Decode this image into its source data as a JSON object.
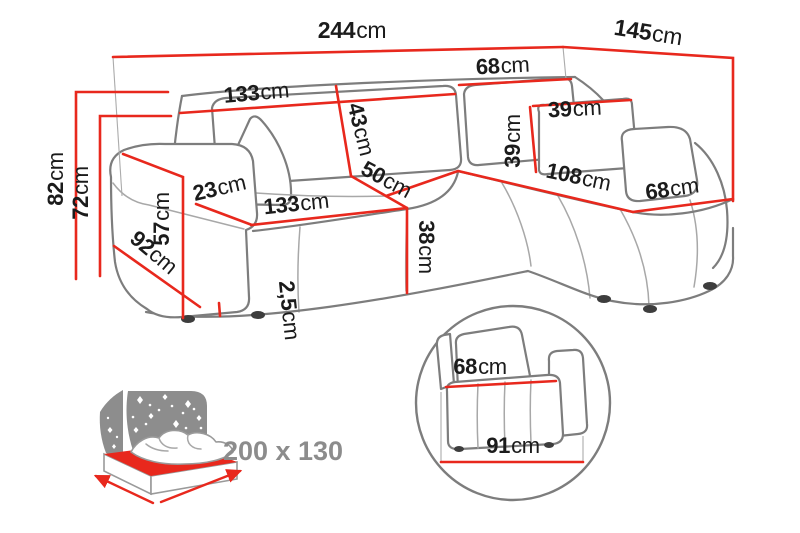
{
  "unit_default": "cm",
  "colors": {
    "dimension_red": "#e8281d",
    "sofa_outline_gray": "#7d7d7d",
    "label_text": "#1b1b1b",
    "muted_gray_label": "#8c8c8c",
    "background": "#ffffff"
  },
  "dims": {
    "total_width": {
      "num": "244",
      "unit": "cm"
    },
    "total_depth": {
      "num": "145",
      "unit": "cm"
    },
    "backrest_left_width": {
      "num": "133",
      "unit": "cm"
    },
    "backrest_right_width": {
      "num": "68",
      "unit": "cm"
    },
    "backrest_height": {
      "num": "43",
      "unit": "cm"
    },
    "pillow_width": {
      "num": "39",
      "unit": "cm"
    },
    "pillow_height": {
      "num": "39",
      "unit": "cm"
    },
    "total_height": {
      "num": "82",
      "unit": "cm"
    },
    "backrest_top_height": {
      "num": "72",
      "unit": "cm"
    },
    "armrest_width": {
      "num": "23",
      "unit": "cm"
    },
    "armrest_height": {
      "num": "57",
      "unit": "cm"
    },
    "armrest_depth": {
      "num": "92",
      "unit": "cm"
    },
    "seat_width": {
      "num": "133",
      "unit": "cm"
    },
    "seat_height": {
      "num": "38",
      "unit": "cm"
    },
    "seat_depth": {
      "num": "50",
      "unit": "cm"
    },
    "chaise_length": {
      "num": "108",
      "unit": "cm"
    },
    "chaise_width": {
      "num": "68",
      "unit": "cm"
    },
    "leg_height": {
      "num": "2,5",
      "unit": "cm"
    },
    "detail_seat_depth": {
      "num": "68",
      "unit": "cm"
    },
    "detail_base_depth": {
      "num": "91",
      "unit": "cm"
    }
  },
  "sleeping_area": {
    "label": "200 x 130"
  }
}
